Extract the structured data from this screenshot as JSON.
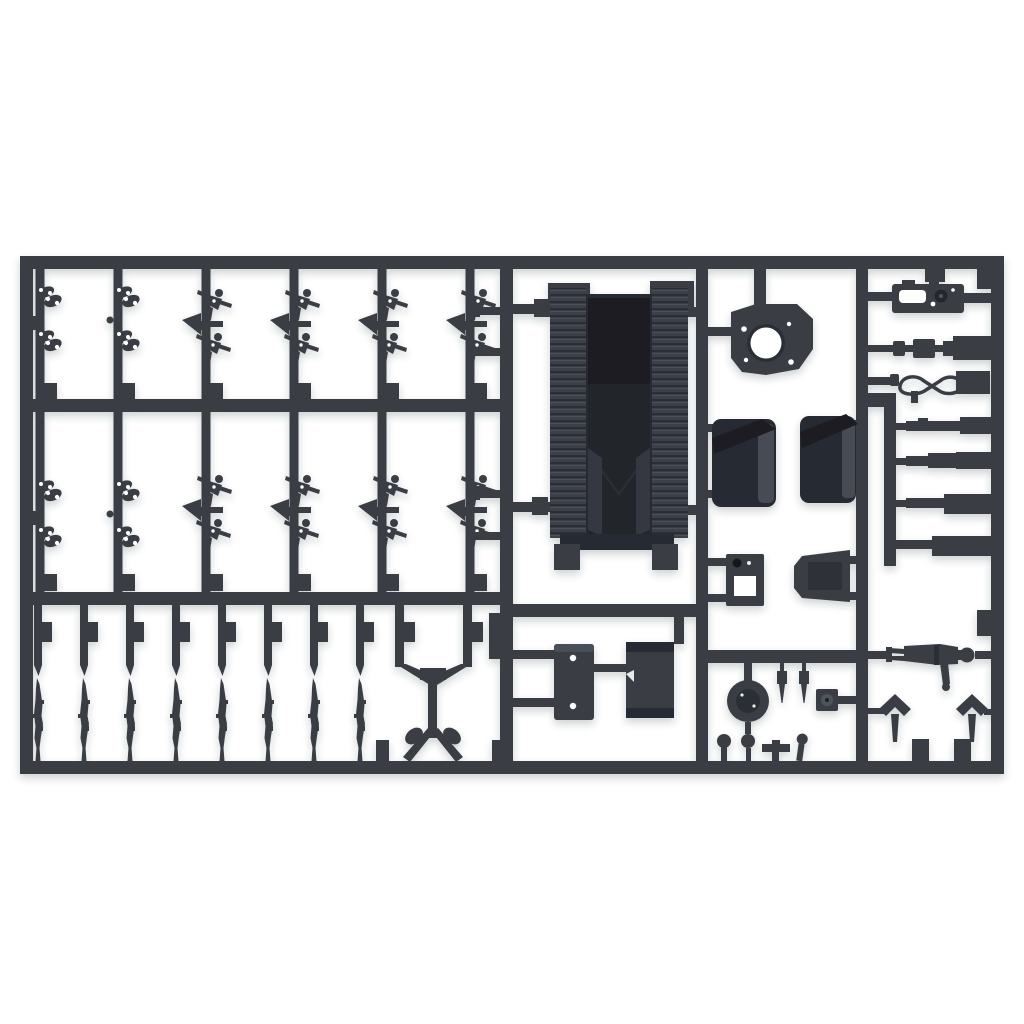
{
  "meta": {
    "type": "product-photo",
    "subject": "Unpainted dark grey injection-moulded plastic model kit sprue with military vehicle, weapon and crew figure parts photographed on a plain white background",
    "alt": "Plastic model kit sprue (parts runner) with many small unassembled parts"
  },
  "colors": {
    "bg": "#ffffff",
    "plastic": "#3a3e45",
    "plasticDark": "#272b31",
    "plasticDarker": "#1b1e23",
    "plasticLight": "#4e535b",
    "recess": "#202329",
    "hole": "#ffffff",
    "holeDim": "#e9e9e9",
    "shadow": "#2a2d33"
  },
  "sprue": {
    "material": "dark grey styrene plastic",
    "layout": "rectangular runner frame, left half a grid of small parts, right half large parts",
    "part_groups": [
      {
        "name": "small-detail-clusters-with-holes",
        "count": 8,
        "location": "upper-left grid columns 1-2"
      },
      {
        "name": "crew-figure-clusters",
        "count": 8,
        "location": "upper-left grid columns 3-6"
      },
      {
        "name": "rifles",
        "count": 8,
        "location": "bottom-left row"
      },
      {
        "name": "machine-gun-tripod",
        "count": 1,
        "location": "bottom-left, right end"
      },
      {
        "name": "vehicle-hull-with-track-sections",
        "count": 1,
        "location": "center"
      },
      {
        "name": "mount-bracket-with-round-opening",
        "count": 1,
        "location": "top center-right"
      },
      {
        "name": "gun-shield-halves",
        "count": 2,
        "location": "center-right"
      },
      {
        "name": "small-mount-brackets",
        "count": 2,
        "location": "center-right, below shields"
      },
      {
        "name": "mounting-plates-with-holes",
        "count": 2,
        "location": "bottom center"
      },
      {
        "name": "road-wheel",
        "count": 1,
        "location": "bottom center-right"
      },
      {
        "name": "pins-and-levers",
        "count": 6,
        "location": "bottom center-right"
      },
      {
        "name": "instrument-panel-plate",
        "count": 1,
        "location": "top right"
      },
      {
        "name": "tow-cable-figure-eight",
        "count": 1,
        "location": "top right"
      },
      {
        "name": "gun-barrel-rods",
        "count": 4,
        "location": "right column"
      },
      {
        "name": "lying-soldier-figure",
        "count": 1,
        "location": "bottom right"
      },
      {
        "name": "three-pronged-trail-ends",
        "count": 2,
        "location": "bottom right"
      }
    ]
  }
}
